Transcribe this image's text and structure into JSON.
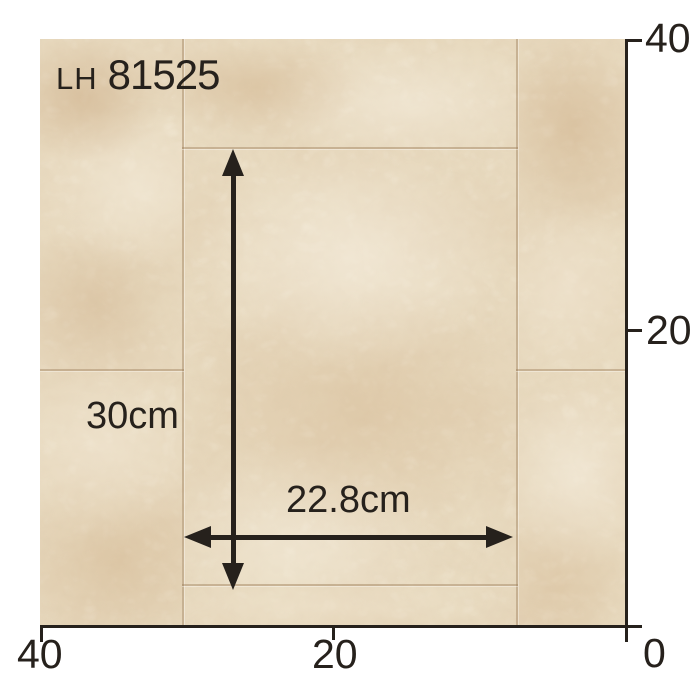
{
  "product": {
    "series": "LH",
    "code": "81525"
  },
  "dimensions": {
    "height_label": "30cm",
    "width_label": "22.8cm"
  },
  "ruler": {
    "right_axis": {
      "ticks": [
        {
          "label": "40"
        },
        {
          "label": "20"
        }
      ]
    },
    "bottom_axis": {
      "ticks": [
        {
          "label": "40"
        },
        {
          "label": "20"
        }
      ]
    },
    "origin_label": "0"
  },
  "colors": {
    "page-bg": "#ffffff",
    "ink": "#26211c",
    "stone-base": "#e9dcc2",
    "stone-light": "#f5eedd",
    "stone-mid": "#d9c3a0",
    "stone-dark": "#c09a6e",
    "seam": "#9a7c58"
  }
}
